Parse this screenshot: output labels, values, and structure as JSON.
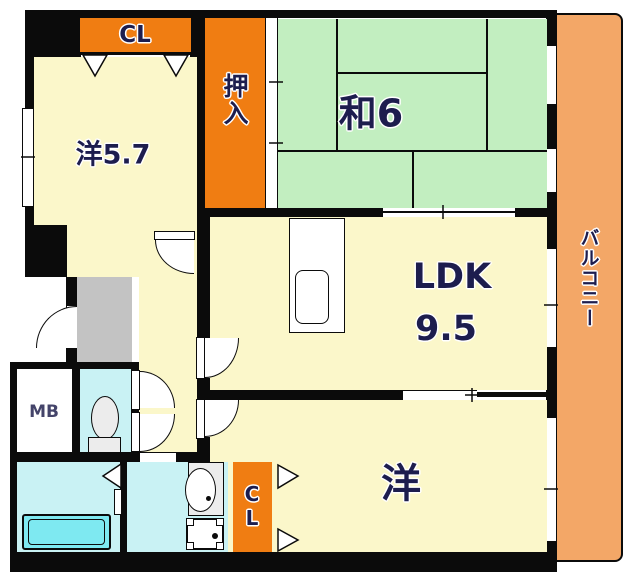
{
  "floorplan": {
    "title": "apartment-floor-plan",
    "rooms": {
      "closet_top": {
        "label": "CL"
      },
      "oshiire": {
        "label": "押入"
      },
      "washitsu": {
        "label": "和6"
      },
      "western_5_7": {
        "label": "洋5.7"
      },
      "ldk": {
        "label": "LDK",
        "size_label": "9.5"
      },
      "western_bottom": {
        "label": "洋"
      },
      "balcony": {
        "label": "バルコニー"
      },
      "meter_box": {
        "label": "MB"
      },
      "closet_bottom": {
        "label": "CL"
      }
    },
    "fixtures": [
      "kitchen-sink",
      "toilet",
      "washbasin",
      "washing-machine-pan",
      "bathtub"
    ],
    "colors": {
      "room_cream": "#FBF7CA",
      "tatami_green": "#C2EEC0",
      "closet_orange": "#F07D12",
      "balcony_orange": "#F3A767",
      "wet_cyan": "#C9F2F4",
      "bathtub_cyan": "#7EE9F1",
      "genkan_gray": "#C3C3C3",
      "wall_black": "#0B0B0B",
      "label_navy": "#1D1D4E",
      "fixture_gray": "#ECECEC"
    }
  }
}
